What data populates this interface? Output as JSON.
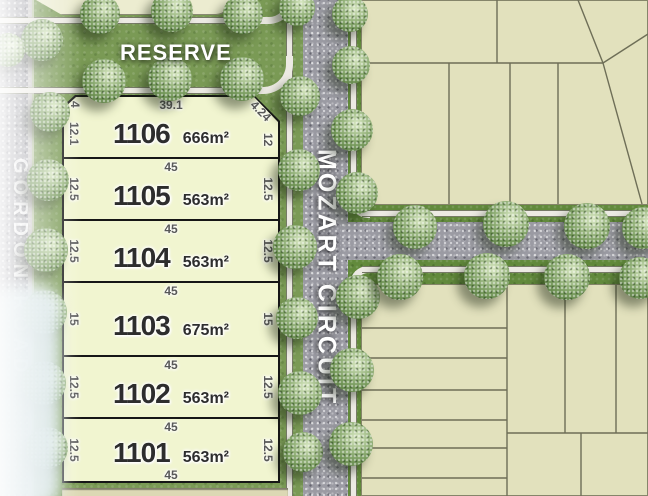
{
  "plan": {
    "reserve_label": "RESERVE",
    "road_vertical": "MOZART CIRCUIT",
    "road_left": "GORDON ROAD",
    "lots": [
      {
        "id": "1106",
        "area": "666m²",
        "dim_top": "39.1",
        "dim_left": "12.1",
        "dim_left_chamfer": "4",
        "dim_right": "12",
        "dim_right_chamfer": "4.24"
      },
      {
        "id": "1105",
        "area": "563m²",
        "dim_top": "45",
        "dim_left": "12.5",
        "dim_right": "12.5"
      },
      {
        "id": "1104",
        "area": "563m²",
        "dim_top": "45",
        "dim_left": "12.5",
        "dim_right": "12.5"
      },
      {
        "id": "1103",
        "area": "675m²",
        "dim_top": "45",
        "dim_left": "15",
        "dim_right": "15"
      },
      {
        "id": "1102",
        "area": "563m²",
        "dim_top": "45",
        "dim_left": "12.5",
        "dim_right": "12.5"
      },
      {
        "id": "1101",
        "area": "563m²",
        "dim_top": "45",
        "dim_left": "12.5",
        "dim_right": "12.5",
        "dim_bottom": "45"
      }
    ],
    "colors": {
      "grass": "#7a9a55",
      "verge_green": "#628a3c",
      "asphalt": "#9b9ba3",
      "footpath": "#eceae3",
      "featured_lot_fill": "#f1f5d0",
      "neighbour_lot_fill": "#e2e1bd",
      "lot_border": "#161616",
      "boundary_line": "#6e6e57",
      "lot_number_text": "#2d2d2d",
      "dimension_text": "#585858",
      "label_text": "#ffffff"
    }
  }
}
